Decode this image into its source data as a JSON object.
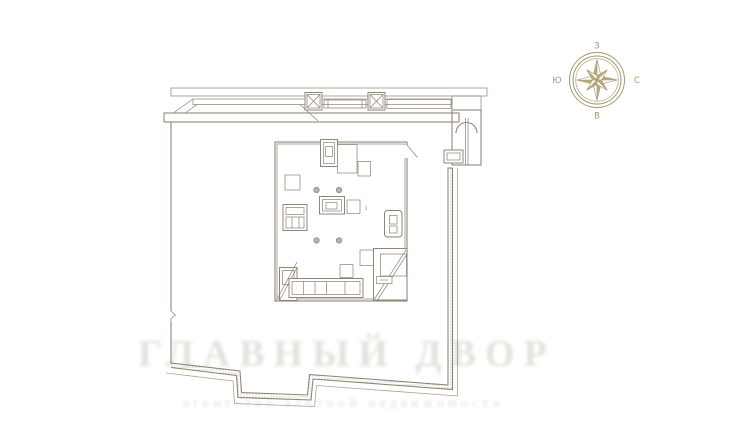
{
  "colors": {
    "paper": "#ffffff",
    "ink": "#8b8272",
    "hatch": "#857c6b",
    "accent": "#b9ad7c",
    "accent2": "#a3996d",
    "dot": "#b9b2a6",
    "wm": "#e3e2dc"
  },
  "compass": {
    "labels": {
      "top": "З",
      "right": "С",
      "bottom": "В",
      "left": "Ю"
    }
  },
  "plan": {
    "tiny_label": "1"
  },
  "watermark": {
    "line1": "ГЛАВНЫЙ ДВОР",
    "line2": "агентство элитной недвижимости"
  }
}
